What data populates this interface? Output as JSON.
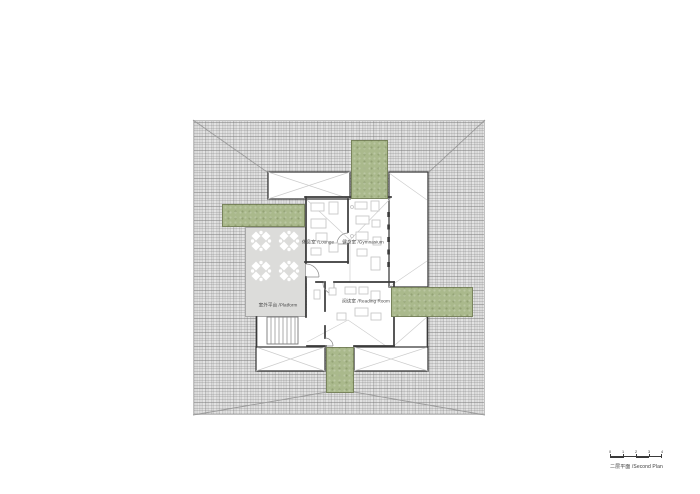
{
  "drawing": {
    "title": "二层平面 /Second Plan",
    "scale_numbers": [
      "0",
      "1",
      "2",
      "3",
      "4"
    ],
    "rooms": {
      "lounge": "休息室 /Lounge",
      "gymnasium": "健身室 /Gymnasium",
      "reading_room": "阅读室 /Reading Room",
      "platform": "室外平台 /Platform"
    },
    "colors": {
      "green_roof": "#aab98c",
      "tile_roof": "#dadada",
      "wall": "#3a3a3a",
      "platform": "#dcdcda"
    }
  }
}
